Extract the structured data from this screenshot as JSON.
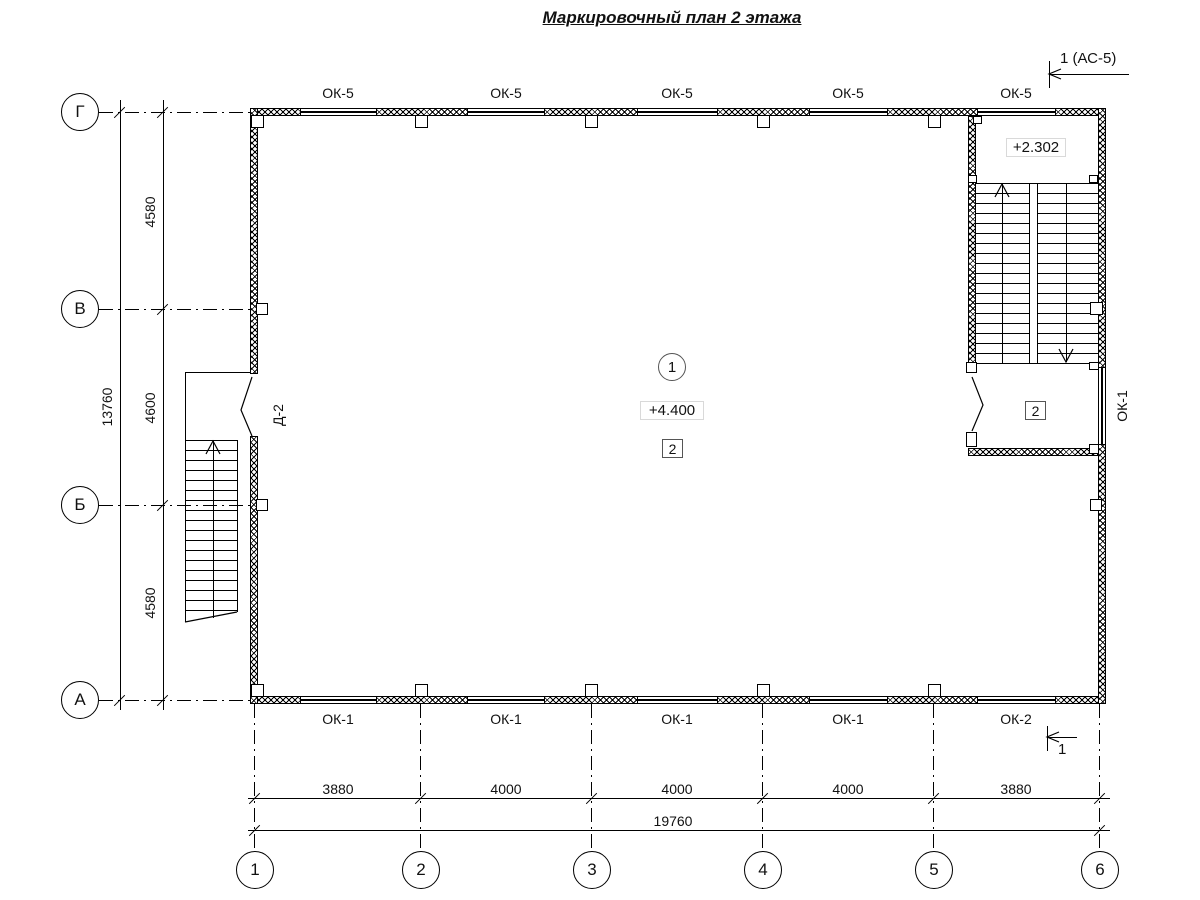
{
  "title": "Маркировочный план 2 этажа",
  "section_marks": {
    "top_label": "1 (АС-5)",
    "bottom_label": "1"
  },
  "axes": {
    "rows": [
      "Г",
      "В",
      "Б",
      "А"
    ],
    "cols": [
      "1",
      "2",
      "3",
      "4",
      "5",
      "6"
    ]
  },
  "dimensions": {
    "left_inner": [
      "4580",
      "4600",
      "4580"
    ],
    "left_total": "13760",
    "bottom_inner": [
      "3880",
      "4000",
      "4000",
      "4000",
      "3880"
    ],
    "bottom_total": "19760"
  },
  "windows": {
    "top": [
      "ОК-5",
      "ОК-5",
      "ОК-5",
      "ОК-5",
      "ОК-5"
    ],
    "bottom": [
      "ОК-1",
      "ОК-1",
      "ОК-1",
      "ОК-1",
      "ОК-2"
    ],
    "right": "ОК-1"
  },
  "door_label": "Д-2",
  "rooms": {
    "room_circle": "1",
    "level_main": "+4.400",
    "hatch_main": "2",
    "hatch_stair": "2",
    "level_stair": "+2.302"
  }
}
